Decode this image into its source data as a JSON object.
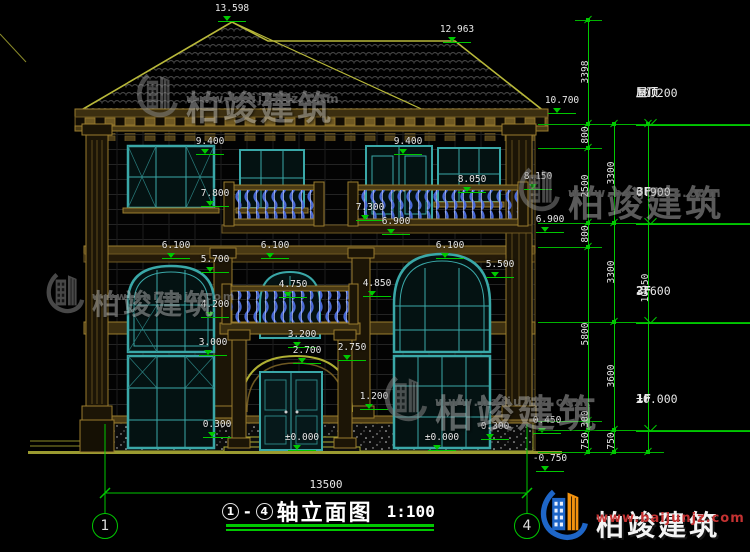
{
  "drawing_title": {
    "axis_start": "1",
    "axis_end": "4",
    "dash": "-",
    "title": "轴立面图",
    "scale": "1:100"
  },
  "overall_width_mm": "13500",
  "dim_labels": [
    {
      "t": "13.598",
      "x": 232,
      "y": 4
    },
    {
      "t": "12.963",
      "x": 457,
      "y": 25
    },
    {
      "t": "10.700",
      "x": 562,
      "y": 96
    },
    {
      "t": "9.400",
      "x": 210,
      "y": 137
    },
    {
      "t": "9.400",
      "x": 408,
      "y": 137
    },
    {
      "t": "8.050",
      "x": 472,
      "y": 175
    },
    {
      "t": "8.150",
      "x": 538,
      "y": 172
    },
    {
      "t": "7.800",
      "x": 215,
      "y": 189
    },
    {
      "t": "7.300",
      "x": 370,
      "y": 203
    },
    {
      "t": "6.900",
      "x": 396,
      "y": 217
    },
    {
      "t": "6.900",
      "x": 550,
      "y": 215
    },
    {
      "t": "6.100",
      "x": 176,
      "y": 241
    },
    {
      "t": "6.100",
      "x": 275,
      "y": 241
    },
    {
      "t": "6.100",
      "x": 450,
      "y": 241
    },
    {
      "t": "5.700",
      "x": 215,
      "y": 255
    },
    {
      "t": "5.500",
      "x": 500,
      "y": 260
    },
    {
      "t": "4.750",
      "x": 293,
      "y": 280
    },
    {
      "t": "4.850",
      "x": 377,
      "y": 279
    },
    {
      "t": "4.200",
      "x": 215,
      "y": 300
    },
    {
      "t": "3.200",
      "x": 302,
      "y": 330
    },
    {
      "t": "3.000",
      "x": 213,
      "y": 338
    },
    {
      "t": "2.700",
      "x": 307,
      "y": 346
    },
    {
      "t": "2.750",
      "x": 352,
      "y": 343
    },
    {
      "t": "1.200",
      "x": 374,
      "y": 392
    },
    {
      "t": "0.300",
      "x": 217,
      "y": 420
    },
    {
      "t": "0.300",
      "x": 495,
      "y": 422
    },
    {
      "t": "±0.000",
      "x": 302,
      "y": 433
    },
    {
      "t": "±0.000",
      "x": 442,
      "y": 433
    },
    {
      "t": "0.450",
      "x": 547,
      "y": 416
    },
    {
      "t": "-0.750",
      "x": 550,
      "y": 454
    }
  ],
  "right_panel": {
    "chains": [
      {
        "x": 588,
        "ticks": [
          20,
          124,
          148,
          223,
          247,
          421,
          430,
          452
        ],
        "segments": [
          {
            "v": "3398",
            "y": 72
          },
          {
            "v": "800",
            "y": 135
          },
          {
            "v": "2500",
            "y": 186
          },
          {
            "v": "800",
            "y": 234
          },
          {
            "v": "5800",
            "y": 334
          },
          {
            "v": "300",
            "y": 419
          },
          {
            "v": "750",
            "y": 441
          }
        ]
      },
      {
        "x": 614,
        "ticks": [
          124,
          223,
          322,
          430,
          452
        ],
        "segments": [
          {
            "v": "3300",
            "y": 173
          },
          {
            "v": "3300",
            "y": 272
          },
          {
            "v": "3600",
            "y": 376
          },
          {
            "v": "750",
            "y": 441
          }
        ]
      },
      {
        "x": 648,
        "ticks": [
          124,
          452
        ],
        "segments": [
          {
            "v": "10950",
            "y": 288
          }
        ]
      }
    ],
    "levels": [
      {
        "name": "屋顶",
        "value": "10.200",
        "y": 124
      },
      {
        "name": "3F",
        "value": "6.900",
        "y": 223
      },
      {
        "name": "2F",
        "value": "3.600",
        "y": 322
      },
      {
        "name": "1F",
        "value": "±0.000",
        "y": 430
      }
    ],
    "ext_lines": [
      {
        "y": 20,
        "x1": 575,
        "x2": 602
      },
      {
        "y": 124,
        "x1": 538,
        "x2": 750
      },
      {
        "y": 148,
        "x1": 538,
        "x2": 602
      },
      {
        "y": 223,
        "x1": 538,
        "x2": 750
      },
      {
        "y": 247,
        "x1": 538,
        "x2": 602
      },
      {
        "y": 322,
        "x1": 538,
        "x2": 750
      },
      {
        "y": 421,
        "x1": 538,
        "x2": 602
      },
      {
        "y": 430,
        "x1": 538,
        "x2": 750
      },
      {
        "y": 452,
        "x1": 538,
        "x2": 664
      }
    ]
  },
  "watermarks": [
    {
      "text": "柏竣建筑",
      "url": "www.baijunjz.com",
      "x": 136,
      "y": 66,
      "icon_h": 52,
      "text_size": 34,
      "url_size": 12,
      "style": "gray"
    },
    {
      "text": "柏竣建筑",
      "url": "www.baijunjz.com",
      "x": 46,
      "y": 266,
      "icon_h": 48,
      "text_size": 28,
      "url_size": 11,
      "style": "gray"
    },
    {
      "text": "柏竣建筑",
      "url": "www.baijunjz.com",
      "x": 518,
      "y": 160,
      "icon_h": 52,
      "text_size": 36,
      "url_size": 12,
      "style": "gray"
    },
    {
      "text": "柏竣建筑",
      "url": "www.baijunjz.com",
      "x": 384,
      "y": 368,
      "icon_h": 54,
      "text_size": 38,
      "url_size": 12,
      "style": "gray"
    },
    {
      "text": "柏竣建筑",
      "url": "www.baijunjz.com",
      "x": 540,
      "y": 481,
      "icon_h": 60,
      "text_size": 28,
      "url_size": 13,
      "style": "logo"
    }
  ],
  "colors": {
    "dimension_green": "#00c800",
    "text_white": "#e8e8e8",
    "outline_yellow": "#b8b83a",
    "trim_brown": "#9a7c2e",
    "window_teal": "#3aa8a8",
    "baluster_blue": "#4a6ad8",
    "logo_blue": "#1e66c8",
    "logo_orange": "#f2920f",
    "watermark_gray": "#8f8f8f",
    "url_red": "#c43232"
  },
  "axis_bubbles": [
    {
      "label": "1",
      "x": 105,
      "y": 526
    },
    {
      "label": "4",
      "x": 527,
      "y": 526
    }
  ]
}
